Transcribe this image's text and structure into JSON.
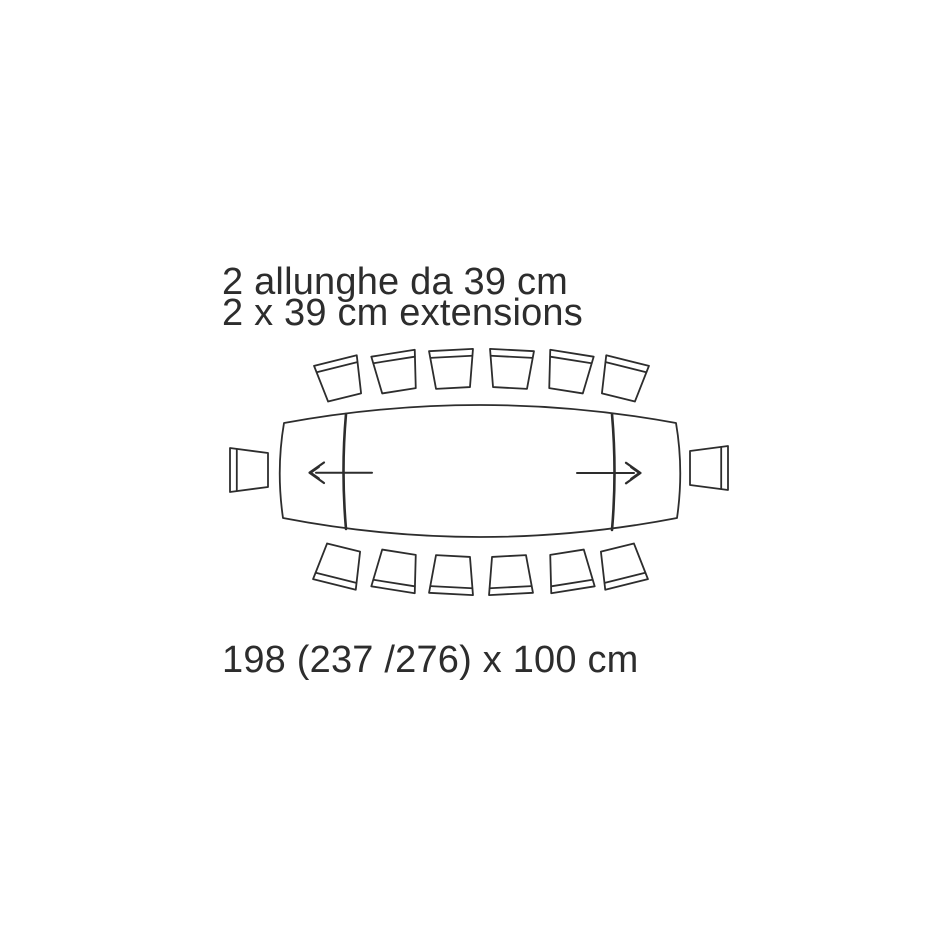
{
  "colors": {
    "background": "#ffffff",
    "ink": "#2d2d2d"
  },
  "captions": {
    "top_line1": "2 allunghe da 39 cm",
    "top_line2": "2 x 39 cm extensions",
    "bottom": "198 (237 /276) x 100 cm"
  },
  "diagram": {
    "type": "table top-view dimension drawing",
    "table_shape": "barrel-shaped extendable table with two end leaves",
    "extensions": {
      "count": 2,
      "leaf_size_cm": 39
    },
    "dimensions": {
      "length_closed_cm": 198,
      "length_extended_cm": [
        237,
        276
      ],
      "width_cm": 100
    },
    "chairs": {
      "top_row": 6,
      "bottom_row": 6,
      "left_end": 1,
      "right_end": 1,
      "total": 14
    },
    "arrows": [
      "leaf pull-out direction left",
      "leaf pull-out direction right"
    ]
  }
}
